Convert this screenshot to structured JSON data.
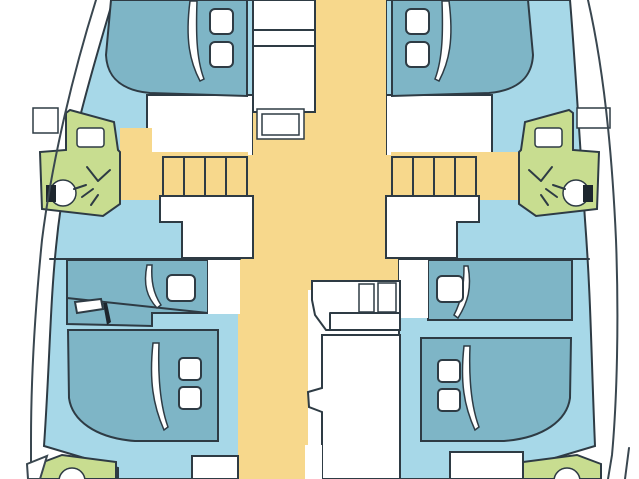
{
  "image": {
    "width": 639,
    "height": 479
  },
  "palette": {
    "background": "#ffffff",
    "hull_interior": "#a7d8e8",
    "bed": "#7eb5c6",
    "corridor": "#f7d88c",
    "bathroom": "#c8dd90",
    "outline": "#2e3b44",
    "hull_line": "#3a4750",
    "fixture_dark": "#1d262e",
    "fixture_white": "#ffffff"
  },
  "floorplan": {
    "type": "catamaran-yacht-interior-deck-plan",
    "orientation": "bow-up",
    "features": [
      "port-hull",
      "starboard-hull",
      "forward-double-berth-port",
      "forward-double-berth-starboard",
      "mid-single-berth-port",
      "extra-angled-berth-port",
      "mid-single-berth-starboard",
      "aft-double-berth-port",
      "aft-double-berth-starboard",
      "head-with-toilet-sink-shower-port",
      "head-with-toilet-sink-shower-starboard",
      "aft-head-port",
      "aft-head-starboard",
      "companionway-stairs-port",
      "companionway-stairs-starboard",
      "central-corridor",
      "forward-steps",
      "galley-unit-with-double-sink",
      "boarding-step-port",
      "boarding-step-starboard"
    ],
    "counts": {
      "cabins": 4,
      "berths": 7,
      "heads": 4,
      "stairs": 2
    }
  }
}
